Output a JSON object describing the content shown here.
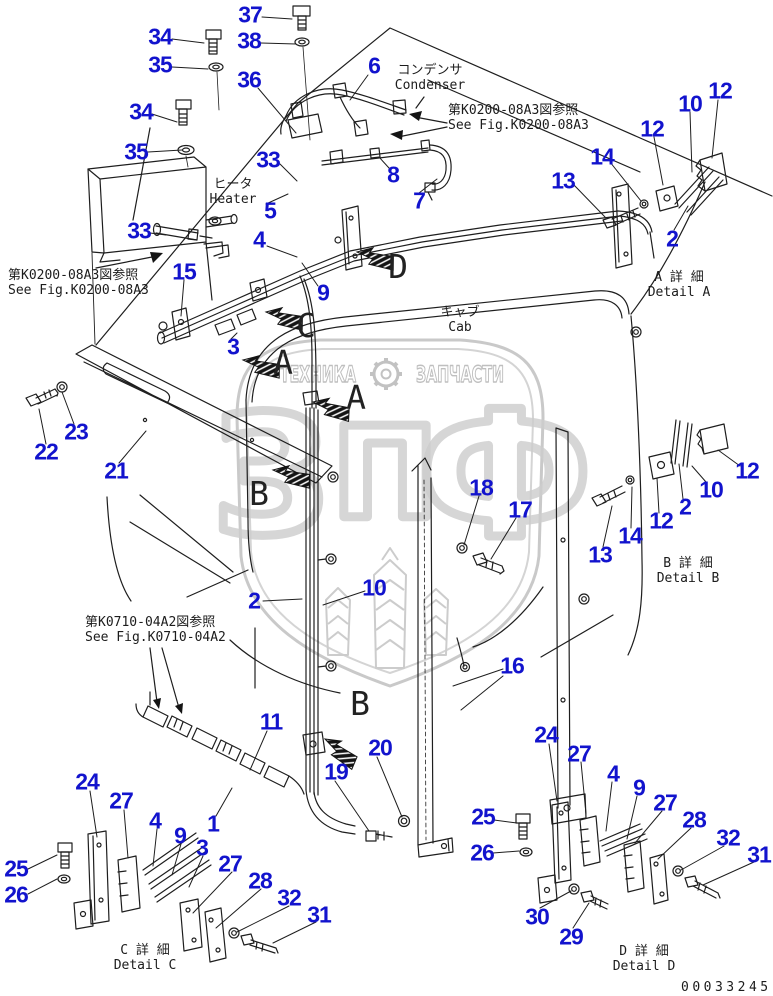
{
  "document": {
    "number": "00033245"
  },
  "colors": {
    "label_blue": "#1213cd",
    "line": "#1e1e1e",
    "watermark": "#c8c8c8"
  },
  "watermark": {
    "left_word": "ТЕХНИКА",
    "right_word": "ЗАПЧАСТИ",
    "monogram": [
      "З",
      "П",
      "Ф"
    ],
    "gear_icon": "gear-icon"
  },
  "annotations": [
    {
      "id": "condenser-label",
      "lines": [
        "コンデンサ",
        "Condenser"
      ],
      "x": 430,
      "y": 63,
      "center": true
    },
    {
      "id": "see-fig-top",
      "lines": [
        "第K0200-08A3図参照",
        "See Fig.K0200-08A3"
      ],
      "x": 448,
      "y": 103,
      "center": false
    },
    {
      "id": "heater-label",
      "lines": [
        "ヒータ",
        "Heater"
      ],
      "x": 233,
      "y": 177,
      "center": true
    },
    {
      "id": "see-fig-left",
      "lines": [
        "第K0200-08A3図参照",
        "See Fig.K0200-08A3"
      ],
      "x": 8,
      "y": 268,
      "center": false
    },
    {
      "id": "cab-label",
      "lines": [
        "キャブ",
        "Cab"
      ],
      "x": 460,
      "y": 305,
      "center": true
    },
    {
      "id": "detail-a-label",
      "lines": [
        "A 詳 細",
        "Detail A"
      ],
      "x": 679,
      "y": 270,
      "center": true
    },
    {
      "id": "detail-b-label",
      "lines": [
        "B 詳 細",
        "Detail B"
      ],
      "x": 688,
      "y": 556,
      "center": true
    },
    {
      "id": "see-fig-0710",
      "lines": [
        "第K0710-04A2図参照",
        "See Fig.K0710-04A2"
      ],
      "x": 85,
      "y": 615,
      "center": false
    },
    {
      "id": "detail-c-label",
      "lines": [
        "C 詳 細",
        "Detail C"
      ],
      "x": 145,
      "y": 943,
      "center": true
    },
    {
      "id": "detail-d-label",
      "lines": [
        "D 詳 細",
        "Detail D"
      ],
      "x": 644,
      "y": 944,
      "center": true
    }
  ],
  "view_arrows": [
    {
      "letter": "D",
      "lx": 398,
      "ly": 278,
      "ax": 357,
      "ay": 252,
      "rot": 18
    },
    {
      "letter": "C",
      "lx": 306,
      "ly": 337,
      "ax": 266,
      "ay": 312,
      "rot": 18
    },
    {
      "letter": "A",
      "lx": 283,
      "ly": 374,
      "ax": 243,
      "ay": 360,
      "rot": 18
    },
    {
      "letter": "A",
      "lx": 356,
      "ly": 409,
      "ax": 313,
      "ay": 402,
      "rot": 20
    },
    {
      "letter": "B",
      "lx": 259,
      "ly": 505,
      "ax": 273,
      "ay": 470,
      "rot": 18
    },
    {
      "letter": "B",
      "lx": 360,
      "ly": 715,
      "ax": 325,
      "ay": 739,
      "rot": 40
    }
  ],
  "part_labels": [
    {
      "t": "37",
      "x": 250,
      "y": 15
    },
    {
      "t": "34",
      "x": 160,
      "y": 37
    },
    {
      "t": "38",
      "x": 249,
      "y": 41
    },
    {
      "t": "35",
      "x": 160,
      "y": 65
    },
    {
      "t": "36",
      "x": 249,
      "y": 80
    },
    {
      "t": "6",
      "x": 374,
      "y": 66
    },
    {
      "t": "34",
      "x": 141,
      "y": 112
    },
    {
      "t": "35",
      "x": 136,
      "y": 152
    },
    {
      "t": "33",
      "x": 268,
      "y": 160
    },
    {
      "t": "8",
      "x": 393,
      "y": 175
    },
    {
      "t": "7",
      "x": 419,
      "y": 201
    },
    {
      "t": "5",
      "x": 270,
      "y": 211
    },
    {
      "t": "33",
      "x": 139,
      "y": 231
    },
    {
      "t": "4",
      "x": 259,
      "y": 240
    },
    {
      "t": "15",
      "x": 184,
      "y": 272
    },
    {
      "t": "9",
      "x": 323,
      "y": 293
    },
    {
      "t": "3",
      "x": 233,
      "y": 347
    },
    {
      "t": "12",
      "x": 652,
      "y": 129
    },
    {
      "t": "10",
      "x": 690,
      "y": 104
    },
    {
      "t": "12",
      "x": 720,
      "y": 91
    },
    {
      "t": "14",
      "x": 602,
      "y": 157
    },
    {
      "t": "13",
      "x": 563,
      "y": 181
    },
    {
      "t": "2",
      "x": 672,
      "y": 239
    },
    {
      "t": "22",
      "x": 46,
      "y": 452
    },
    {
      "t": "23",
      "x": 76,
      "y": 432
    },
    {
      "t": "21",
      "x": 116,
      "y": 471
    },
    {
      "t": "18",
      "x": 481,
      "y": 488
    },
    {
      "t": "17",
      "x": 520,
      "y": 510
    },
    {
      "t": "13",
      "x": 600,
      "y": 555
    },
    {
      "t": "14",
      "x": 630,
      "y": 536
    },
    {
      "t": "12",
      "x": 661,
      "y": 521
    },
    {
      "t": "2",
      "x": 685,
      "y": 507
    },
    {
      "t": "10",
      "x": 711,
      "y": 490
    },
    {
      "t": "12",
      "x": 747,
      "y": 471
    },
    {
      "t": "2",
      "x": 254,
      "y": 601
    },
    {
      "t": "10",
      "x": 374,
      "y": 588
    },
    {
      "t": "16",
      "x": 512,
      "y": 666
    },
    {
      "t": "11",
      "x": 271,
      "y": 722
    },
    {
      "t": "20",
      "x": 380,
      "y": 748
    },
    {
      "t": "19",
      "x": 336,
      "y": 772
    },
    {
      "t": "24",
      "x": 87,
      "y": 782
    },
    {
      "t": "27",
      "x": 121,
      "y": 801
    },
    {
      "t": "4",
      "x": 155,
      "y": 821
    },
    {
      "t": "9",
      "x": 180,
      "y": 836
    },
    {
      "t": "1",
      "x": 213,
      "y": 824
    },
    {
      "t": "3",
      "x": 202,
      "y": 848
    },
    {
      "t": "27",
      "x": 230,
      "y": 864
    },
    {
      "t": "28",
      "x": 260,
      "y": 881
    },
    {
      "t": "32",
      "x": 289,
      "y": 898
    },
    {
      "t": "31",
      "x": 319,
      "y": 915
    },
    {
      "t": "25",
      "x": 16,
      "y": 869
    },
    {
      "t": "26",
      "x": 16,
      "y": 895
    },
    {
      "t": "24",
      "x": 546,
      "y": 735
    },
    {
      "t": "27",
      "x": 579,
      "y": 754
    },
    {
      "t": "4",
      "x": 613,
      "y": 774
    },
    {
      "t": "9",
      "x": 639,
      "y": 788
    },
    {
      "t": "27",
      "x": 665,
      "y": 803
    },
    {
      "t": "28",
      "x": 694,
      "y": 820
    },
    {
      "t": "32",
      "x": 728,
      "y": 838
    },
    {
      "t": "31",
      "x": 759,
      "y": 855
    },
    {
      "t": "25",
      "x": 483,
      "y": 817
    },
    {
      "t": "26",
      "x": 482,
      "y": 853
    },
    {
      "t": "30",
      "x": 537,
      "y": 917
    },
    {
      "t": "29",
      "x": 571,
      "y": 937
    }
  ]
}
